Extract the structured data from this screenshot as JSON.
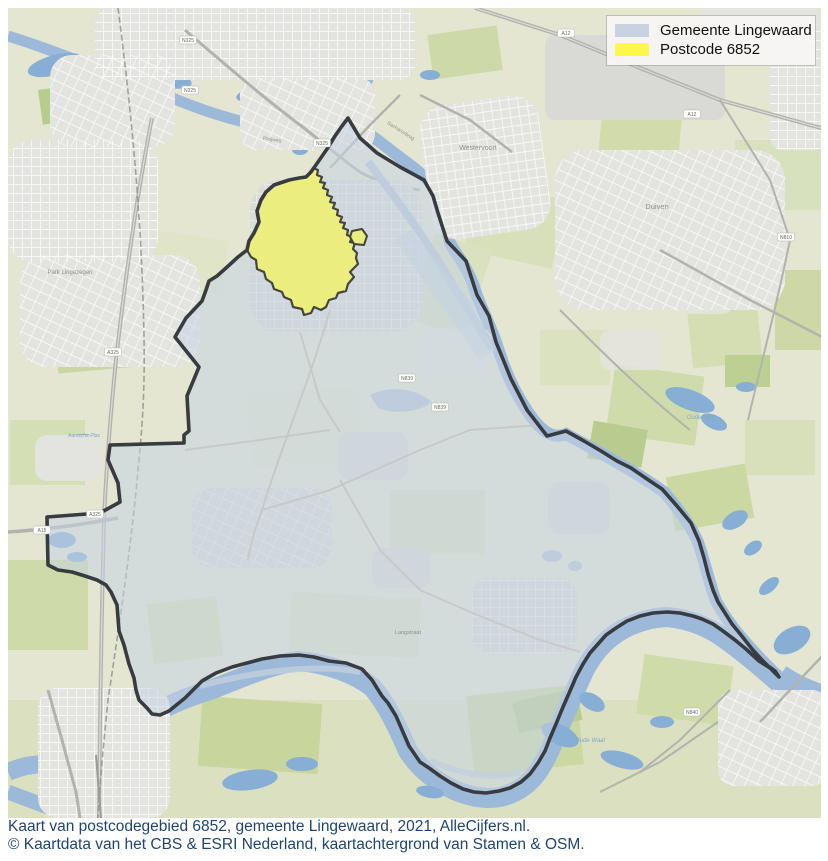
{
  "legend": {
    "items": [
      {
        "label": "Gemeente Lingewaard",
        "color": "#c8d2e1"
      },
      {
        "label": "Postcode 6852",
        "color": "#fcf84a"
      }
    ]
  },
  "caption": {
    "line1": "Kaart van postcodegebied 6852, gemeente Lingewaard, 2021, AlleCijfers.nl.",
    "line2": "© Kaartdata van het CBS & ESRI Nederland, kaartachtergrond van Stamen & OSM."
  },
  "map": {
    "labels": [
      {
        "text": "Westervoort"
      },
      {
        "text": "Duiven"
      },
      {
        "text": "Park Lingezegen"
      },
      {
        "text": "Langstraat"
      },
      {
        "text": "Oude Rijn"
      },
      {
        "text": "Oude Waal"
      },
      {
        "text": "Sacharovbrug"
      },
      {
        "text": "Pleijweg"
      },
      {
        "text": "Aamsche Plas"
      }
    ],
    "shields": [
      {
        "text": "N325"
      },
      {
        "text": "N325"
      },
      {
        "text": "N325"
      },
      {
        "text": "A325"
      },
      {
        "text": "A325"
      },
      {
        "text": "A15"
      },
      {
        "text": "A12"
      },
      {
        "text": "A12"
      },
      {
        "text": "N839"
      },
      {
        "text": "N839"
      },
      {
        "text": "N840"
      },
      {
        "text": "N810"
      }
    ],
    "colors": {
      "municipality_fill": "#c7d3e2",
      "postcode_fill": "#eef075",
      "boundary": "#383b3f",
      "water": "#9db9d9",
      "land": "#e4e6d2",
      "caption_text": "#1e4476"
    }
  }
}
